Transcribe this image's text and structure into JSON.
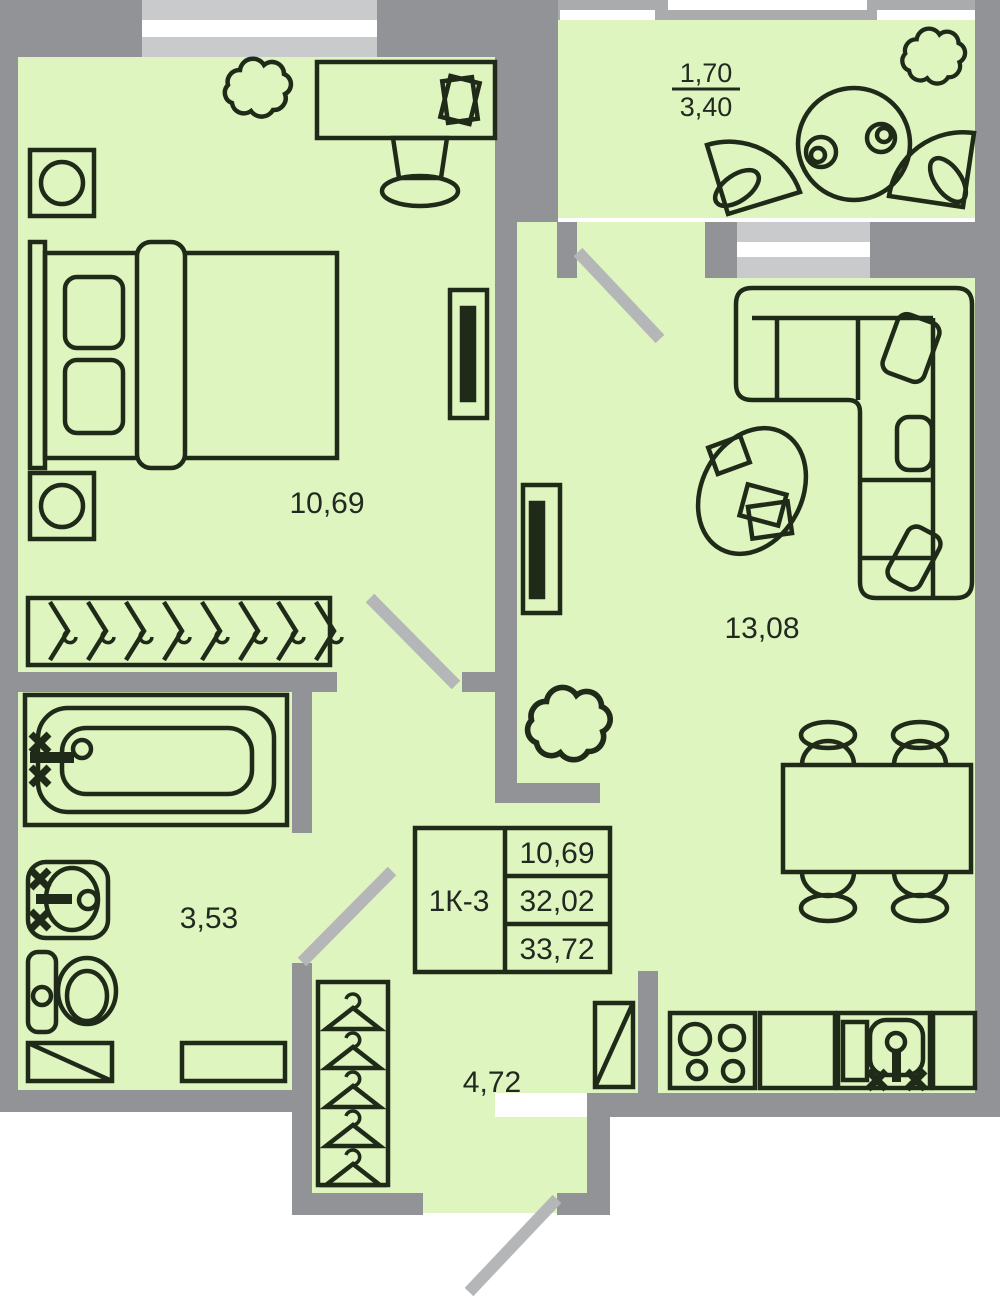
{
  "plan": {
    "stamp": {
      "unit": "1К-3",
      "rows": [
        "10,69",
        "32,02",
        "33,72"
      ]
    },
    "rooms": {
      "bedroom": "10,69",
      "living": "13,08",
      "bathroom": "3,53",
      "hallway": "4,72",
      "balcony_reduced": "1,70",
      "balcony_full": "3,40"
    },
    "colors": {
      "floor": "#def5c0",
      "wall": "#919396",
      "window_frame": "#c8cacc",
      "window_glass": "#ffffff",
      "door_swing": "#b4b6b8",
      "furniture_line": "#202a18",
      "text": "#222920"
    }
  }
}
